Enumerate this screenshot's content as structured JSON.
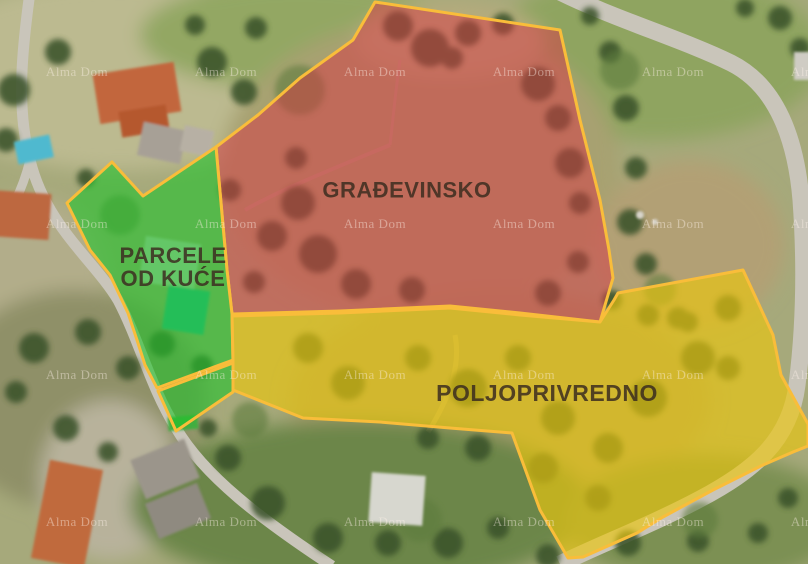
{
  "map": {
    "border_color": "#f9bd3a",
    "label_color": "#3b2d20",
    "watermark": {
      "text": "Alma Dom",
      "color": "#fff2ea",
      "opacity": 0.42,
      "font_size": 13,
      "rows": [
        72,
        224,
        375,
        522
      ],
      "cols": [
        77,
        226,
        375,
        524,
        673,
        822
      ]
    },
    "zones": [
      {
        "name": "gradevinsko",
        "label": "GRAĐEVINSKO",
        "fill": "#d63a45",
        "opacity": 0.52,
        "points": "375,2 560,30 580,120 600,200 609,250 613,278 600,322 520,313 450,306 340,311 232,314 227,270 216,147 258,115 300,78 353,40",
        "label_x": 407,
        "label_y": 190,
        "font_size": 22
      },
      {
        "name": "parcele-od-kuce",
        "label": "PARCELE\nOD KUĆE",
        "fill": "#21c32b",
        "opacity": 0.6,
        "points": "112,162 143,196 216,147 227,270 232,314 233,360 157,388 145,365 137,340 128,313 110,275 90,250 67,203",
        "label_x": 173,
        "label_y": 267,
        "font_size": 22
      },
      {
        "name": "parcele-od-kuce-wedge",
        "label": "",
        "fill": "#21c32b",
        "opacity": 0.6,
        "points": "158,391 233,363 233,392 176,431",
        "label_x": 0,
        "label_y": 0,
        "font_size": 22
      },
      {
        "name": "poljoprivredno",
        "label": "POLJOPRIVREDNO",
        "fill": "#eac50e",
        "opacity": 0.66,
        "points": "232,316 340,313 450,308 520,315 600,322 614,300 618,293 743,270 773,335 781,375 808,424 808,446 793,452 763,465 713,490 663,517 637,533 583,557 568,558 540,510 512,433 450,428 380,422 303,418 248,396 233,390 233,362",
        "label_x": 547,
        "label_y": 393,
        "font_size": 23
      }
    ]
  }
}
